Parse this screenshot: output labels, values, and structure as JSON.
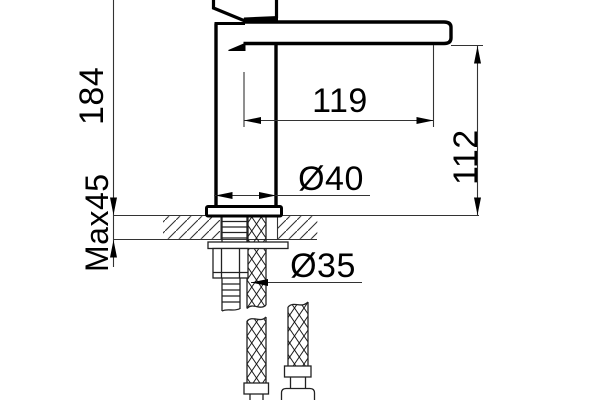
{
  "drawing": {
    "subject": "Single-lever basin mixer tap - side elevation installation drawing with flexible supply hoses",
    "units": "mm",
    "background": "#ffffff",
    "outline_color": "#000000",
    "thin_line_color": "#333333",
    "labels": {
      "height_above_deck": "184",
      "max_deck_thickness": "Max45",
      "spout_reach": "119",
      "spout_height": "112",
      "body_diameter": "Ø40",
      "hole_diameter": "Ø35"
    },
    "dimensions": [
      {
        "id": "height-above-deck",
        "value": "184",
        "orientation": "vertical",
        "measures": "overall height from deck to top of tap"
      },
      {
        "id": "max-deck-thickness",
        "value": "Max45",
        "orientation": "vertical",
        "measures": "maximum counter/deck thickness"
      },
      {
        "id": "spout-reach",
        "value": "119",
        "orientation": "horizontal",
        "measures": "spout reach from body centerline"
      },
      {
        "id": "spout-height",
        "value": "112",
        "orientation": "vertical",
        "measures": "spout outlet height above deck"
      },
      {
        "id": "body-diameter",
        "value": "Ø40",
        "orientation": "horizontal",
        "measures": "tap body diameter"
      },
      {
        "id": "hole-diameter",
        "value": "Ø35",
        "orientation": "horizontal",
        "measures": "required mounting hole diameter"
      }
    ]
  }
}
